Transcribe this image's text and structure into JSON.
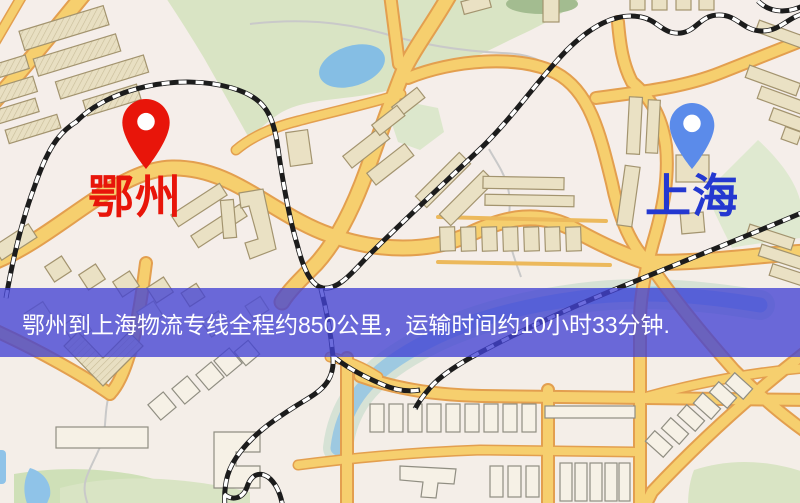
{
  "theme": {
    "origin-color": "#E8150A",
    "origin-pin": "#E8150A",
    "destination-color": "#2438D0",
    "destination-pin": "#5B8BEA",
    "banner-bg": "rgba(66,66,212,0.78)",
    "banner-text": "#FFFFFF"
  },
  "map": {
    "origin": {
      "name": "鄂州"
    },
    "destination": {
      "name": "上海"
    },
    "route": {
      "distance": "约850公里",
      "duration": "约10小时33分钟"
    },
    "banner": {
      "text": "鄂州到上海物流专线全程约850公里，运输时间约10小时33分钟."
    },
    "legend_colors": {
      "road": "#F6CF6E",
      "road_casing": "#E39F4F",
      "park": "#D9E4C4",
      "water": "#8FC3E8",
      "building": "#EAE1C4",
      "railway": "#1C1C1C"
    }
  }
}
